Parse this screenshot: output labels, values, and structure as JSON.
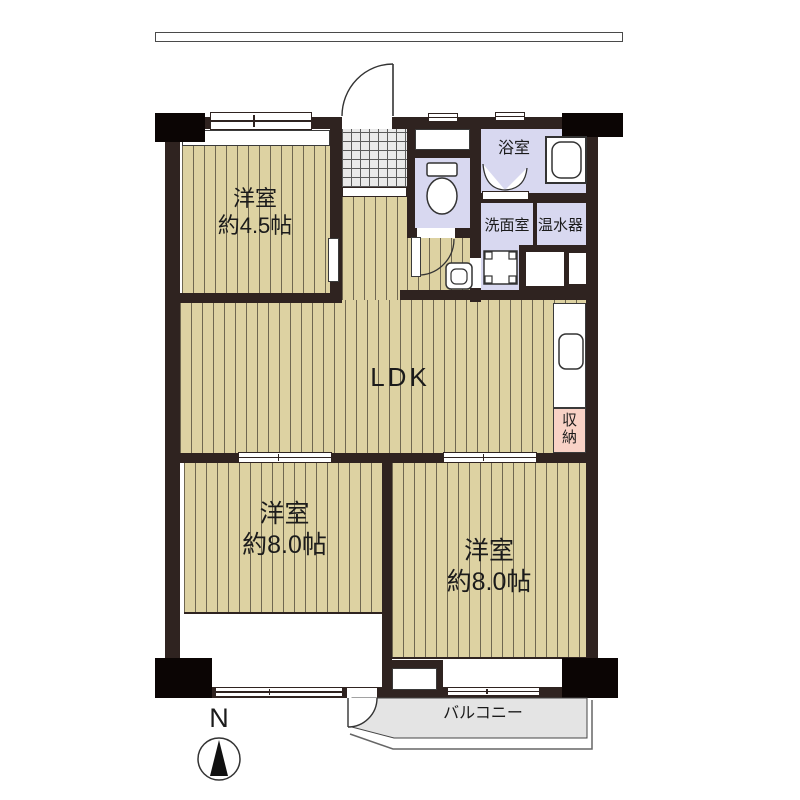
{
  "compass": {
    "label": "N"
  },
  "rooms": {
    "bedroom_small": {
      "name": "洋室",
      "size": "約4.5帖"
    },
    "ldk": {
      "label": "LDK"
    },
    "bedroom_sw": {
      "name": "洋室",
      "size": "約8.0帖"
    },
    "bedroom_se": {
      "name": "洋室",
      "size": "約8.0帖"
    },
    "bath": {
      "label": "浴室"
    },
    "washroom": {
      "label": "洗面室"
    },
    "water_heater": {
      "label": "温水器"
    },
    "storage": {
      "label": "収納"
    },
    "balcony": {
      "label": "バルコニー"
    }
  },
  "colors": {
    "wall": "#2f2320",
    "pillar": "#0b0504",
    "wood": "#ddd2a2",
    "wood_line": "#6f6750",
    "wet": "#d8d8f0",
    "storage": "#f8d2c6",
    "tile": "#e9e9e9",
    "balcony": "#e4e4e4",
    "text": "#1b1b1b"
  }
}
